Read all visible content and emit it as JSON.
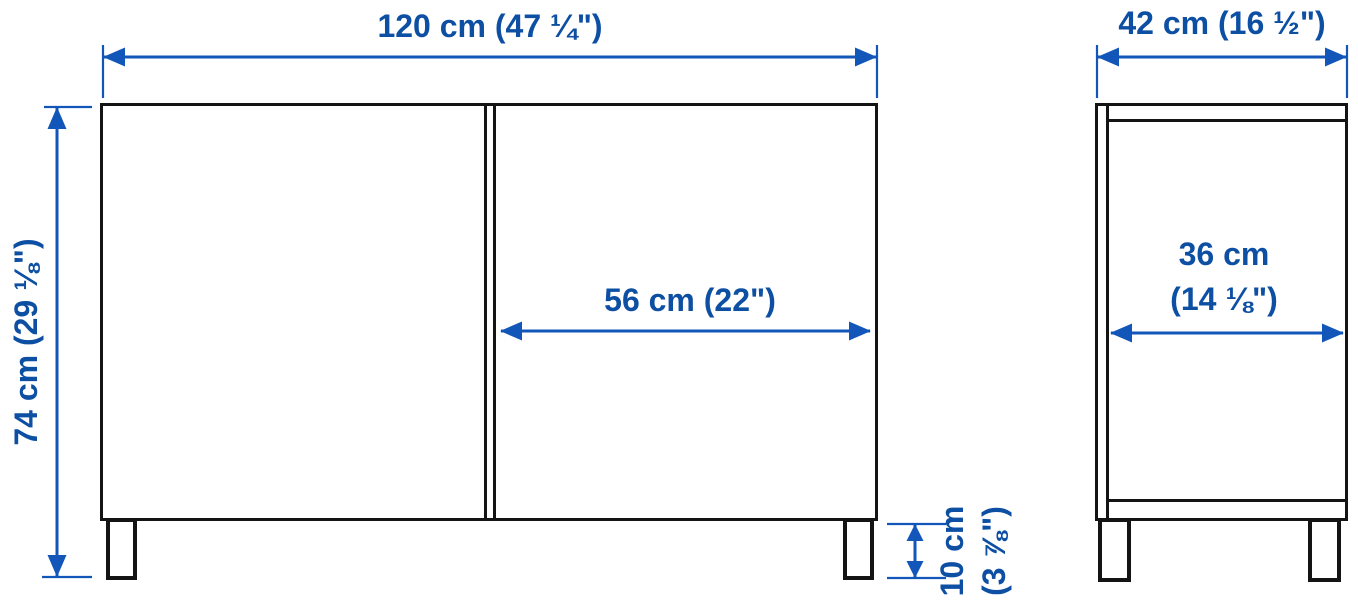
{
  "diagram_type": "furniture-dimension-diagram",
  "colors": {
    "dimension_blue": "#1156b8",
    "label_blue": "#0d4fa3",
    "outline_black": "#141414",
    "background": "#ffffff"
  },
  "front_view": {
    "width": {
      "label": "120 cm (47 ¼\")"
    },
    "height": {
      "label": "74 cm (29 ⅛\")"
    },
    "door_width": {
      "label": "56 cm (22\")"
    },
    "leg_height": {
      "lines": [
        "10 cm",
        "(3 ⅞\")"
      ]
    }
  },
  "side_view": {
    "depth": {
      "label": "42 cm (16 ½\")"
    },
    "inner_depth": {
      "lines": [
        "36 cm",
        "(14 ⅛\")"
      ]
    }
  }
}
